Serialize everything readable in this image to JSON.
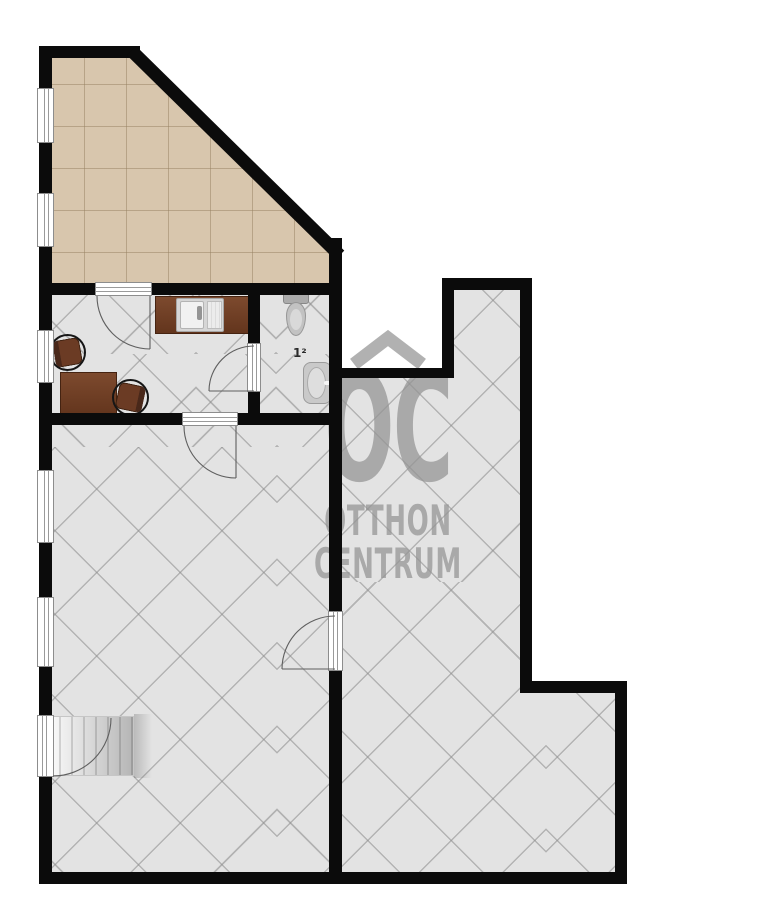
{
  "watermark": {
    "initials": "OC",
    "name_line1": "OTTHON",
    "name_line2": "CENTRUM",
    "roof_icon": "roof-chevron",
    "color": "#949494"
  },
  "labels": {
    "bath_area": "1²"
  },
  "colors": {
    "wall": "#0b0b0b",
    "floor_gray": "#e3e3e3",
    "floor_tile_beige": "#d8c6ad",
    "hatch_line": "#8c8c8c",
    "wood_brown": "#6b3b24",
    "fixture_gray": "#c4c4c4",
    "background": "#ffffff"
  },
  "fixtures": {
    "terrace": "tiled-room",
    "office": "room-with-desk-and-chairs",
    "bathroom": "toilet-and-washbasin",
    "hall": "large-room-with-stairs",
    "right_room": "large-l-shaped-room"
  }
}
